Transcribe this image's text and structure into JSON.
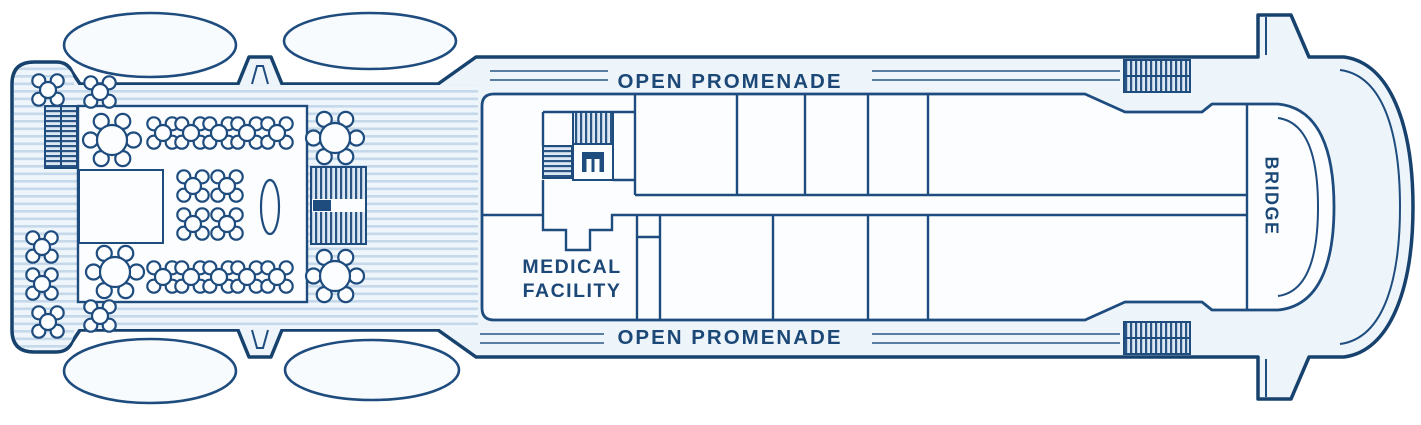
{
  "labels": {
    "open_promenade_top": "OPEN PROMENADE",
    "open_promenade_bottom": "OPEN PROMENADE",
    "medical_facility_line1": "MEDICAL",
    "medical_facility_line2": "FACILITY",
    "bridge": "BRIDGE"
  },
  "colors": {
    "line": "#1e4c7e",
    "hull_line": "#17426e",
    "text": "#1c4877",
    "deck_fill": "#edf4fa",
    "deck_stripe": "#c5d9ea",
    "room_fill": "#fcfdff",
    "hatch_line": "#2a5584",
    "background": "#ffffff"
  },
  "icons": [
    "lifeboat-icon",
    "davit-icon",
    "table-with-chairs-icon",
    "stairs-icon",
    "elevator-icon",
    "pillar-oval-icon",
    "bridge-wing-icon"
  ],
  "furniture": {
    "large_tables": [
      [
        112,
        140
      ],
      [
        335,
        138
      ],
      [
        115,
        272
      ],
      [
        335,
        276
      ]
    ],
    "small_tables": [
      [
        163,
        133
      ],
      [
        191,
        133
      ],
      [
        219,
        133
      ],
      [
        247,
        133
      ],
      [
        277,
        133
      ],
      [
        193,
        186
      ],
      [
        227,
        186
      ],
      [
        193,
        224
      ],
      [
        227,
        224
      ],
      [
        163,
        277
      ],
      [
        191,
        277
      ],
      [
        219,
        277
      ],
      [
        247,
        277
      ],
      [
        277,
        277
      ],
      [
        48,
        90
      ],
      [
        100,
        92
      ],
      [
        42,
        247
      ],
      [
        42,
        284
      ],
      [
        48,
        322
      ],
      [
        100,
        316
      ]
    ]
  }
}
